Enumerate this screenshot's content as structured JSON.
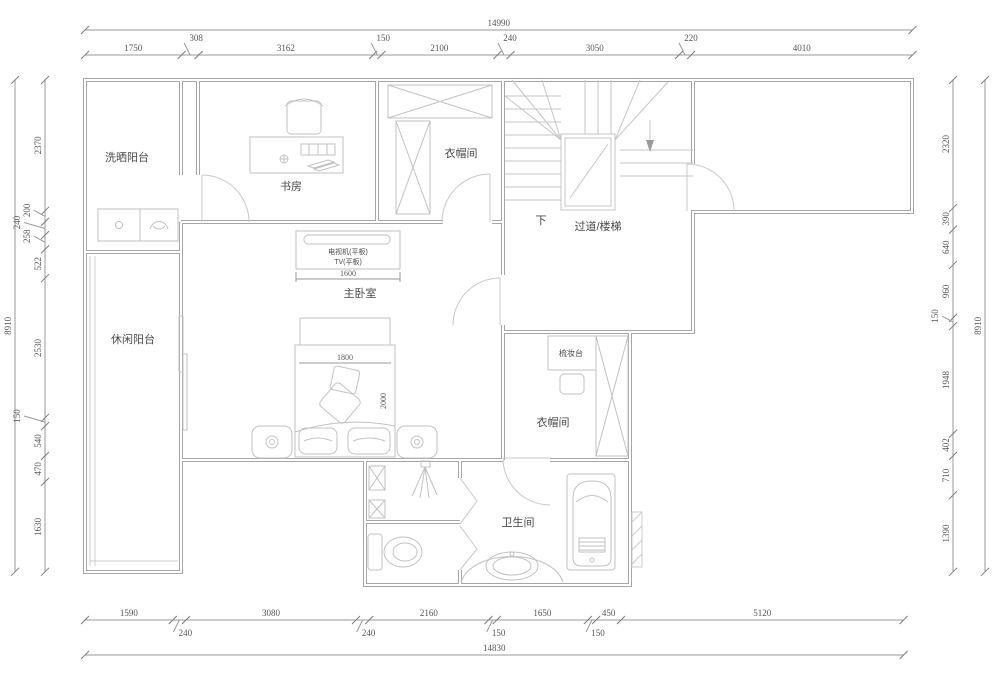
{
  "plan": {
    "rooms": {
      "laundry_balcony": "洗晒阳台",
      "study": "书房",
      "cloakroom_top": "衣帽间",
      "stairs_down": "下",
      "hallway_stairs": "过道/楼梯",
      "master_bedroom": "主卧室",
      "leisure_balcony": "休闲阳台",
      "dressing_table": "梳妆台",
      "cloakroom_right": "衣帽间",
      "bathroom": "卫生间"
    },
    "furniture_labels": {
      "tv_cabinet": "电视机(平板)",
      "tv": "TV(平板)",
      "tv_cabinet_width": "1600",
      "bed_width": "1800",
      "bed_length": "2000"
    }
  },
  "dimensions": {
    "top": {
      "total": 14990,
      "segments": [
        1750,
        308,
        3162,
        150,
        2100,
        240,
        3050,
        220,
        4010
      ]
    },
    "bottom": {
      "total": 14830,
      "segments": [
        1590,
        240,
        3080,
        240,
        2160,
        150,
        1650,
        150,
        450,
        5120
      ]
    },
    "left": {
      "total": 8910,
      "segments": [
        2370,
        200,
        240,
        258,
        522,
        2530,
        150,
        540,
        470,
        1630
      ]
    },
    "right": {
      "total": 8910,
      "segments": [
        2320,
        390,
        640,
        960,
        150,
        1948,
        402,
        710,
        1390
      ]
    }
  },
  "colors": {
    "background": "#ffffff",
    "wall_line": "#a6a6a6",
    "furniture_line": "#c2c2c2",
    "dimension_line": "#9a9a9a",
    "dimension_text": "#565656",
    "label_text": "#4a4a4a"
  }
}
